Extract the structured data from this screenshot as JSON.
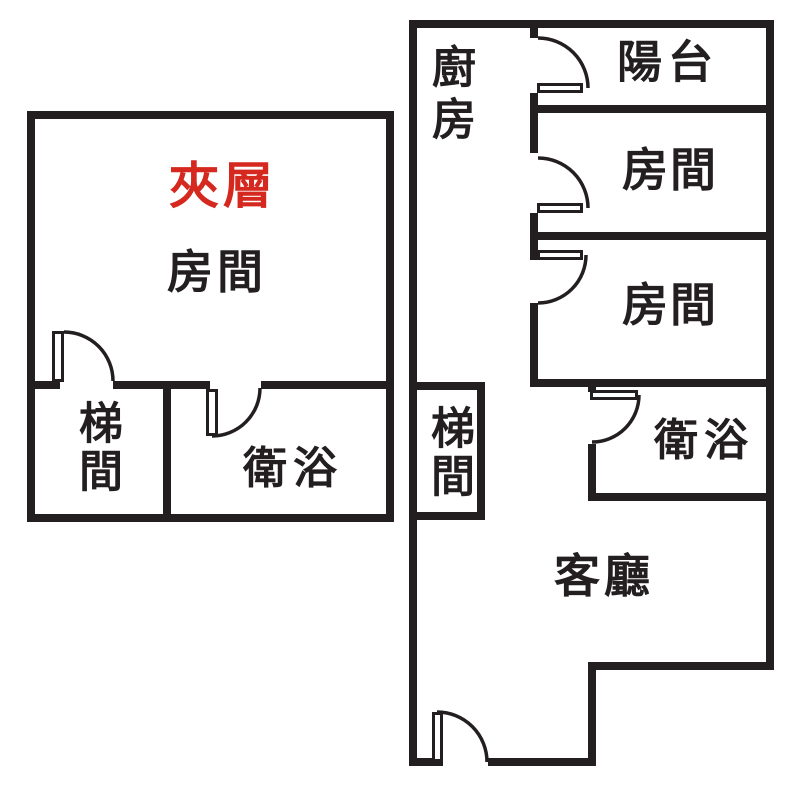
{
  "colors": {
    "wall": "#231f20",
    "accent_red": "#d5281e",
    "background": "#ffffff"
  },
  "left_unit": {
    "mezzanine_label": "夾層",
    "room_label": "房間",
    "stairwell_label": "梯間",
    "bathroom_label": "衛浴"
  },
  "right_unit": {
    "kitchen_label": "廚房",
    "balcony_label": "陽台",
    "room1_label": "房間",
    "room2_label": "房間",
    "stairwell_label": "梯間",
    "bathroom_label": "衛浴",
    "living_room_label": "客廳"
  }
}
